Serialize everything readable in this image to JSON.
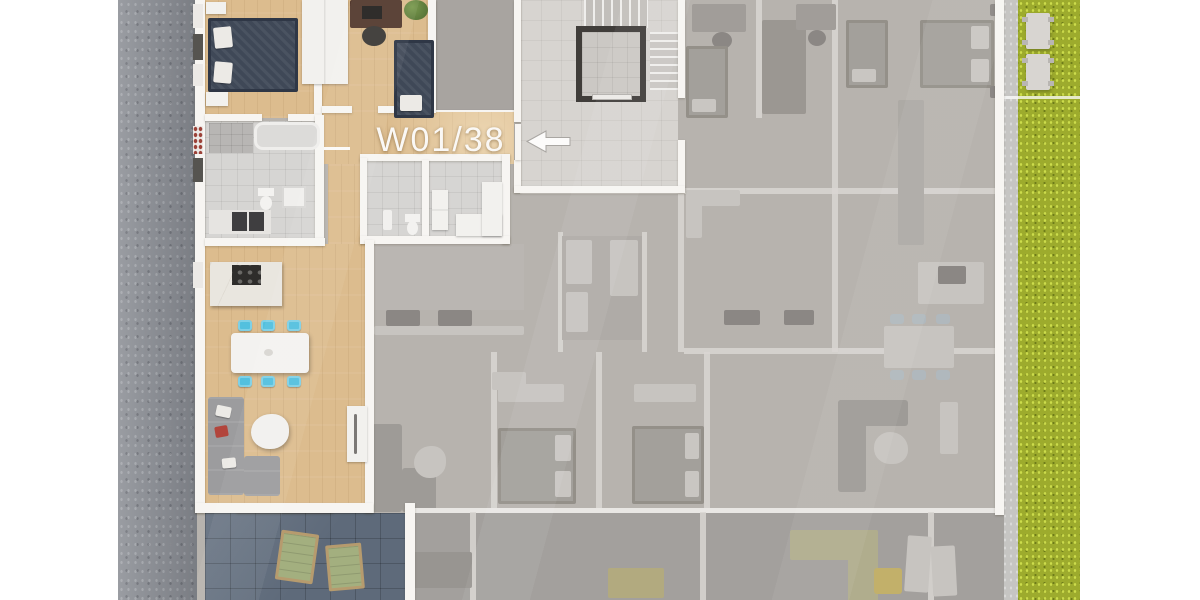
{
  "scene": {
    "description": "3D rendered apartment building floor plan, top view, one unit highlighted in colour while all neighbouring units are greyed out",
    "background_color": "#ffffff"
  },
  "unit_marker": {
    "label": "W01/38",
    "text_color": "#faf8f5",
    "arrow_direction": "left"
  },
  "highlighted_unit": {
    "rooms": [
      "bedroom-main",
      "bedroom-second",
      "bathroom",
      "wc",
      "storage",
      "entry-hallway",
      "living-kitchen",
      "terrace"
    ],
    "furniture": [
      "double-bed",
      "single-bed",
      "desk-with-chair",
      "wardrobe",
      "shower",
      "bathtub",
      "toilet",
      "washing-machine",
      "vanity-double-sink",
      "kitchen-island-cooktop",
      "dining-table",
      "dining-chairs-x6",
      "corner-sofa",
      "coffee-table",
      "sideboard",
      "lounge-chairs-x2"
    ]
  },
  "common_area": {
    "elements": [
      "staircase",
      "elevator",
      "corridor"
    ],
    "entrance_door": "left side of corridor"
  },
  "inactive_area": {
    "description": "neighbouring apartments greyed out with faint furniture",
    "balcony_row": "bottom edge"
  },
  "surroundings": {
    "left": "gravel strip",
    "right": "lawn with two picnic tables",
    "picnic_table_count": 2
  },
  "palette": {
    "wood": "#dcbc8e",
    "tile": "#d6d5d3",
    "hall_tile": "#d7d4d0",
    "terrace": "#5e6a7a",
    "gray_base": "#b7b3ae",
    "wall": "#f7f5f2",
    "grass": "#9dab2d",
    "gravel": "#8f9298",
    "path": "#c6c5c3",
    "chair_cyan": "#53c0de",
    "bed_dark": "#3f4857",
    "label_white": "#faf8f5"
  }
}
